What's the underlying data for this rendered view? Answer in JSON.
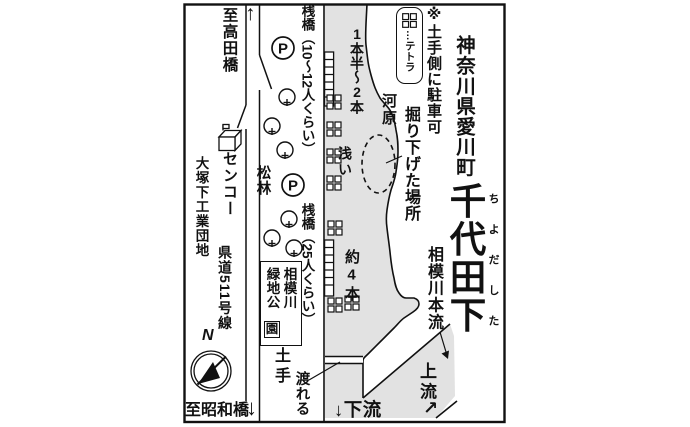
{
  "colors": {
    "water": "#e2e2e2",
    "line": "#111111"
  },
  "header": {
    "prefecture_town": "神奈川県愛川町",
    "spot_name": "千代田下",
    "furigana": "ちよだした"
  },
  "legend": {
    "parking_note": "※土手側に駐車可",
    "tetra_label": "…テトラ"
  },
  "river": {
    "kawara": "河原",
    "dug_down_spot": "掘り下げた場所",
    "rods_upper": "1本半〜2本",
    "shallow": "浅い",
    "rods_lower": "約4本",
    "main_stream": "相模川本流",
    "upstream": "上流",
    "upstream_arrow": "↗",
    "downstream": "↓下流",
    "cross_here": "渡れる",
    "bank": "土手"
  },
  "roads": {
    "to_takata_bridge": "至高田橋",
    "to_showa_bridge": "至昭和橋",
    "up_arrow": "↑",
    "down_arrow": "↓",
    "route_name": "県道511号線"
  },
  "facilities": {
    "pier_upper": "桟橋（10〜12人くらい）",
    "pier_lower": "桟橋（25人くらい）",
    "parking_mark": "P",
    "senko": "センコー",
    "industrial_estate": "大塚下工業団地",
    "pine_grove": "松林",
    "park_name_col_right": "相模川",
    "park_name_col_left": "緑地公",
    "park_name_boxed": "園"
  },
  "compass": {
    "north": "N"
  }
}
